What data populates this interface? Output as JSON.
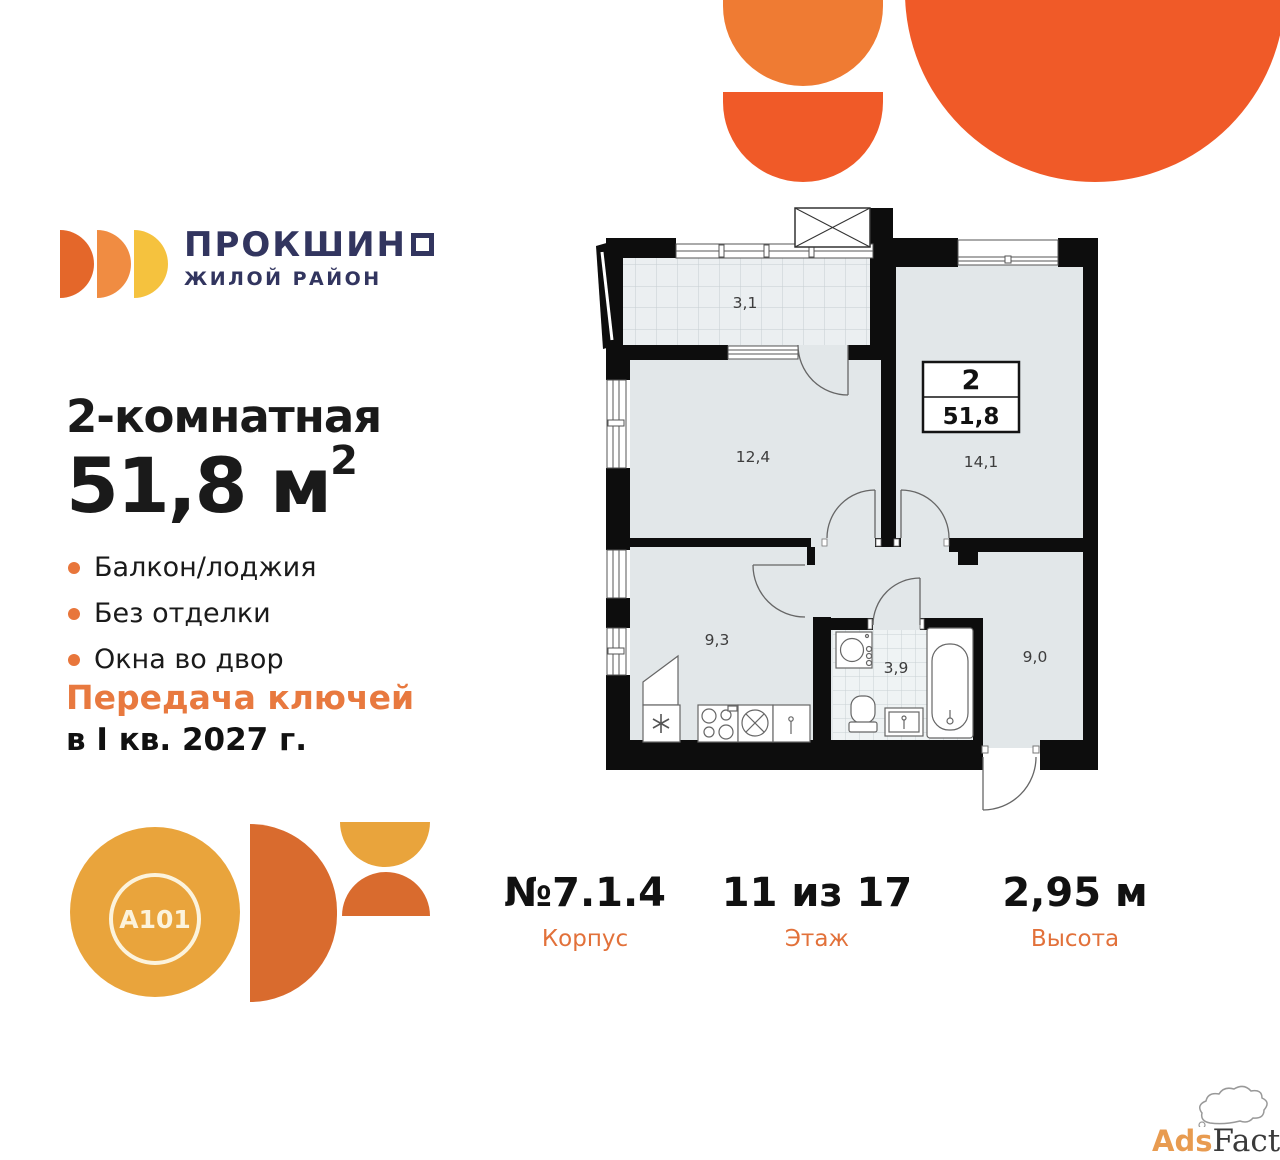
{
  "brand": {
    "name_display": "ПРОКШИН",
    "name_full": "ПРОКШИНО",
    "subtitle": "ЖИЛОЙ РАЙОН"
  },
  "listing": {
    "title": "2-комнатная",
    "area": "51,8 м",
    "area_exponent": "2",
    "features": [
      "Балкон/лоджия",
      "Без отделки",
      "Окна во двор"
    ],
    "handover_line1": "Передача ключей",
    "handover_line2": "в I кв. 2027 г."
  },
  "plan": {
    "summary": {
      "rooms": "2",
      "area": "51,8"
    },
    "room_labels": {
      "balcony": "3,1",
      "living": "12,4",
      "bedroom": "14,1",
      "kitchen": "9,3",
      "bathroom": "3,9",
      "hallway": "9,0"
    }
  },
  "details": {
    "building": {
      "value": "№7.1.4",
      "label": "Корпус"
    },
    "floor": {
      "value": "11 из 17",
      "label": "Этаж"
    },
    "height": {
      "value": "2,95 м",
      "label": "Высота"
    }
  },
  "developer": {
    "name": "A101"
  },
  "watermark": {
    "part1": "Ads",
    "part2": "Factory"
  },
  "colors": {
    "orange": "#F05A28",
    "orange_light": "#EF7B33",
    "navy": "#32355F",
    "accent_text": "#E2713A",
    "bullet": "#E8763B",
    "logo_d1": "#E4672A",
    "logo_d2": "#F08C42",
    "logo_d3": "#F5C23E",
    "a101_yellow": "#E9A43C",
    "a101_orange": "#D96B2E",
    "floor": "#E2E7E9",
    "wall": "#0D0D0D"
  }
}
